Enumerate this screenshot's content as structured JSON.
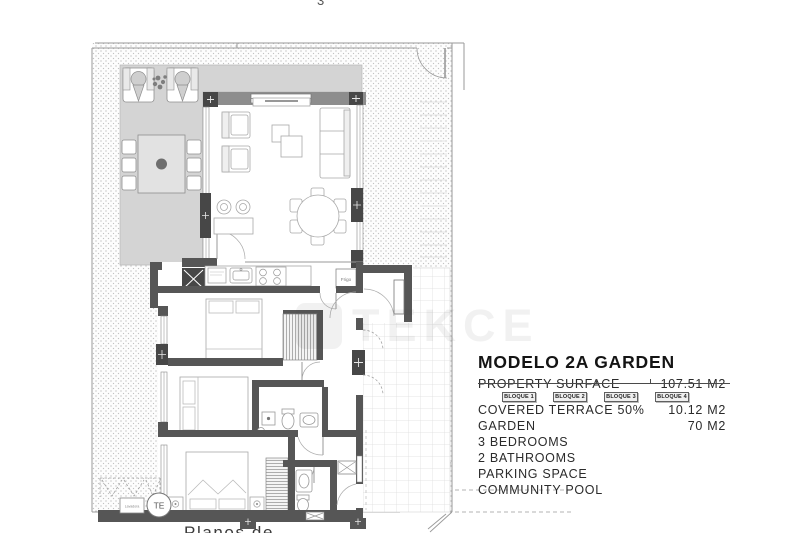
{
  "partials": {
    "top_clipped": "3",
    "bottom_clipped": "Planos de"
  },
  "watermark": {
    "text": "TEKCE"
  },
  "floor_plan": {
    "labels": {
      "fridge": "Frigo",
      "water_heater": "TE",
      "washer": "Lavadora"
    },
    "colors": {
      "wall": "#565656",
      "wall_dark": "#474747",
      "terrace": "#d4d4d4",
      "garden_dot": "#b5b5b5",
      "tile_line": "#dedede",
      "furniture_line": "#a8a8a8"
    }
  },
  "details": {
    "title": "MODELO 2A GARDEN",
    "rows": [
      {
        "label": "PROPERTY SURFACE",
        "value": "107.51 M2"
      },
      {
        "label": "COVERED TERRACE 50%",
        "value": "10.12 M2"
      },
      {
        "label": "GARDEN",
        "value": "70 M2"
      },
      {
        "label": "3 BEDROOMS",
        "value": ""
      },
      {
        "label": "2 BATHROOMS",
        "value": ""
      },
      {
        "label": "PARKING SPACE",
        "value": ""
      },
      {
        "label": "COMMUNITY POOL",
        "value": ""
      }
    ],
    "blocks": [
      "BLOQUE 1",
      "BLOQUE 2",
      "BLOQUE 3",
      "BLOQUE 4"
    ]
  }
}
